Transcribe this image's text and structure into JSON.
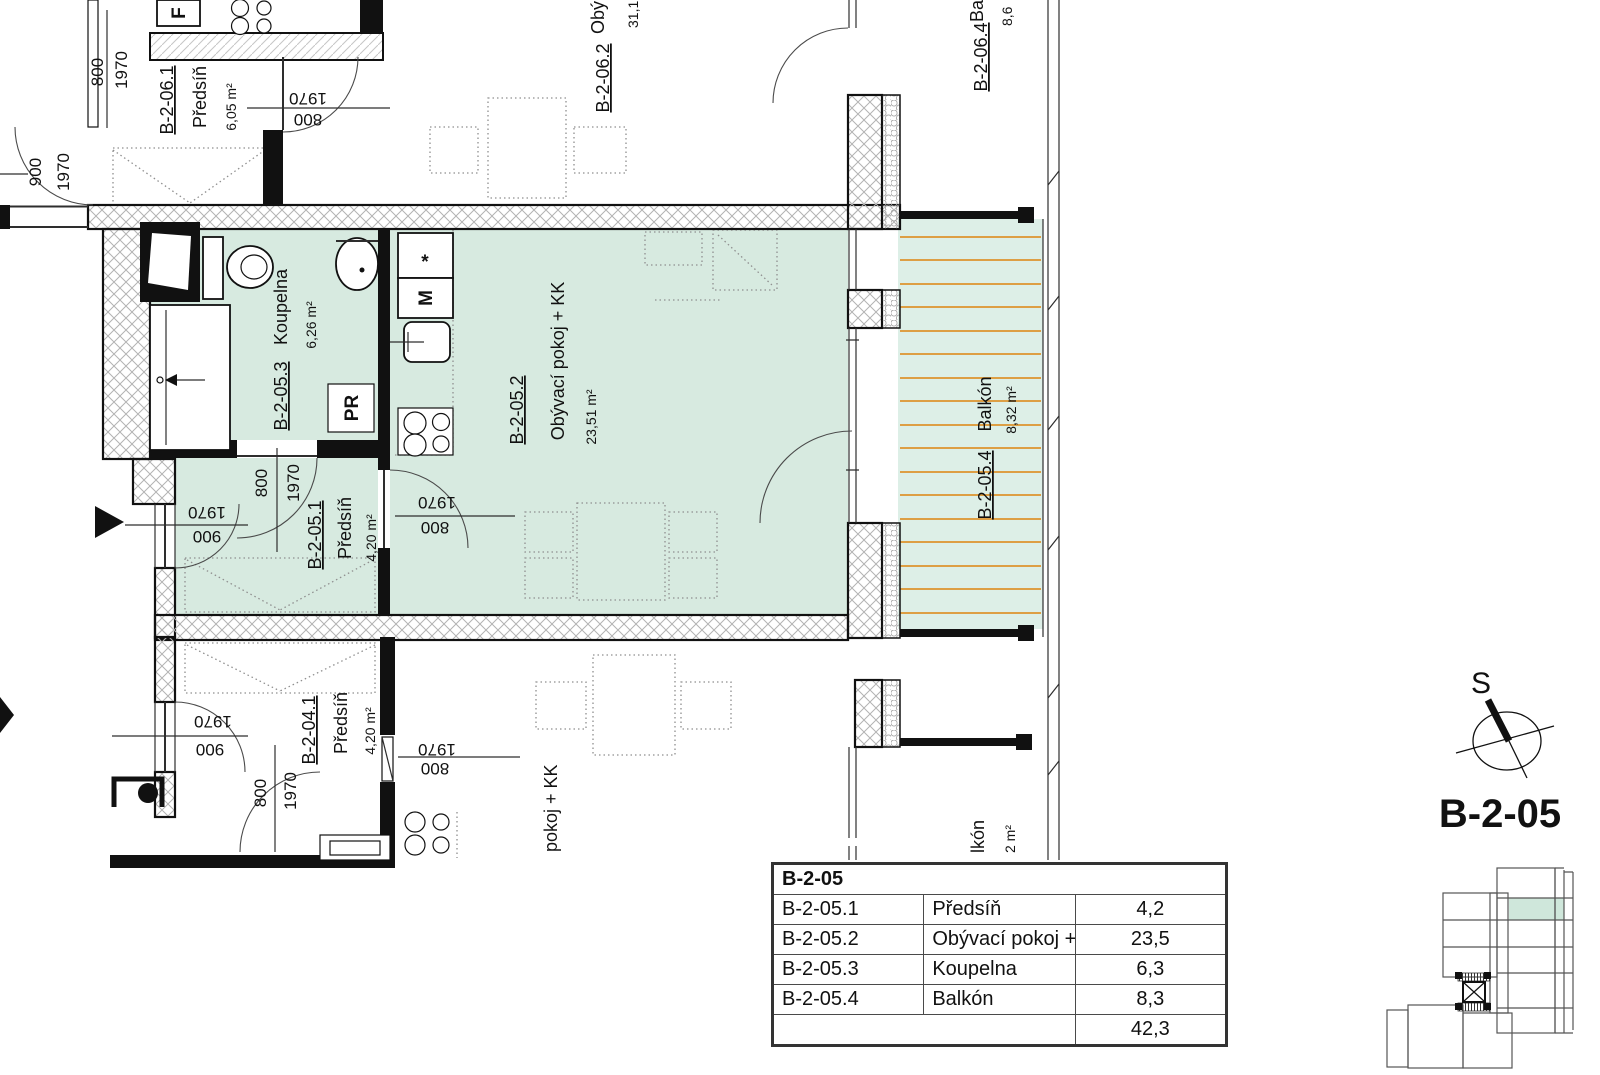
{
  "sheet": {
    "title": "B-2-05",
    "north_label": "S"
  },
  "rooms": {
    "b2051": {
      "code": "B-2-05.1",
      "name": "Předsíň",
      "area": "4,20 m²"
    },
    "b2052": {
      "code": "B-2-05.2",
      "name": "Obývací pokoj + KK",
      "area": "23,51 m²"
    },
    "b2053": {
      "code": "B-2-05.3",
      "name": "Koupelna",
      "area": "6,26 m²"
    },
    "b2054": {
      "code": "B-2-05.4",
      "name": "Balkón",
      "area": "8,32 m²"
    },
    "b2061": {
      "code": "B-2-06.1",
      "name": "Předsíň",
      "area": "6,05 m²"
    },
    "b2062": {
      "code": "B-2-06.2",
      "name_partial": "Obý",
      "area_partial": "31,1"
    },
    "b2064": {
      "code": "B-2-06.4",
      "name_partial": "Ba",
      "area_partial": "8,6"
    },
    "b2041": {
      "code": "B-2-04.1",
      "name": "Předsíň",
      "area": "4,20 m²"
    },
    "b204": {
      "living_partial": "pokoj + KK",
      "balcony_partial": "lkón",
      "balcony_area_partial": "2 m²"
    }
  },
  "dims": {
    "w800": "800",
    "w900": "900",
    "h1970": "1970"
  },
  "symbols": {
    "fridge": "F",
    "freezer_star": "*",
    "appliance_m": "M",
    "washer": "PR"
  },
  "colors": {
    "room_green": "#d7eae0",
    "balcony_green": "#ddefe7",
    "deck_orange": "#dd9f45"
  },
  "area_table": {
    "header": "B-2-05",
    "rows": [
      {
        "code": "B-2-05.1",
        "name": "Předsíň",
        "area": "4,2"
      },
      {
        "code": "B-2-05.2",
        "name": "Obývací pokoj + KK",
        "area": "23,5"
      },
      {
        "code": "B-2-05.3",
        "name": "Koupelna",
        "area": "6,3"
      },
      {
        "code": "B-2-05.4",
        "name": "Balkón",
        "area": "8,3"
      }
    ],
    "total": "42,3"
  }
}
